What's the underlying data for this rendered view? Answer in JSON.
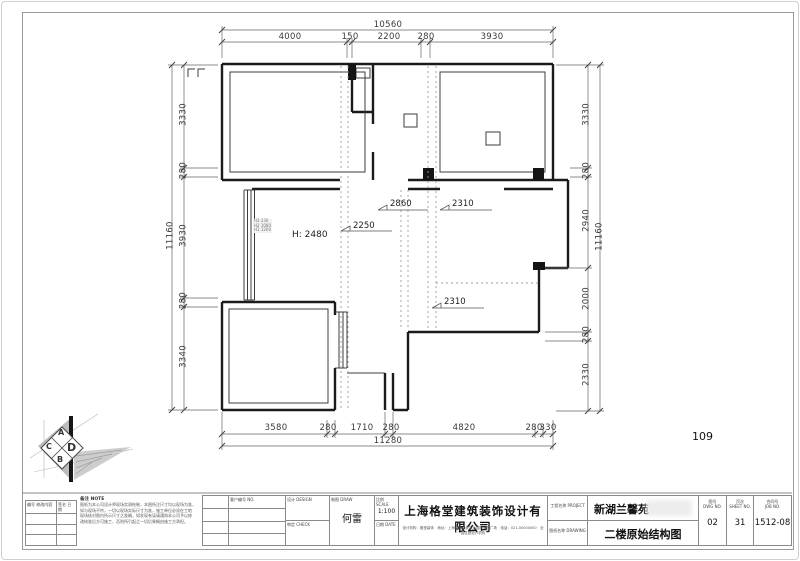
{
  "drawing": {
    "sheet_note": "109",
    "room_height": "H: 2480",
    "dim_2250": "2250",
    "dim_2860": "2860",
    "dim_2310_top": "2310",
    "dim_2310_bottom": "2310",
    "window_note_1": "H3 230",
    "window_note_2": "H2 1080",
    "window_note_3": "H1 1200"
  },
  "dims": {
    "top": {
      "overall": "10560",
      "s": [
        "4000",
        "150",
        "2200",
        "280",
        "3930"
      ]
    },
    "bottom": {
      "overall": "11280",
      "s": [
        "3580",
        "280",
        "1710",
        "280",
        "4820",
        "280",
        "330"
      ]
    },
    "left": {
      "overall": "11160",
      "s": [
        "3330",
        "280",
        "3930",
        "280",
        "3340"
      ]
    },
    "right": {
      "overall": "11160",
      "s": [
        "3330",
        "280",
        "2940",
        "2000",
        "280",
        "2330"
      ]
    }
  },
  "logo": {
    "letters": [
      "A",
      "C",
      "D",
      "B"
    ]
  },
  "titleblock": {
    "revision": {
      "col1": "编号 修改内容",
      "col2": "签名 日期"
    },
    "notes": {
      "header": "备注 NOTE",
      "line1": "图纸为本公司设计师现场实测绘制，本图所注尺寸均以现场为准，",
      "line2": "如与现场不符，一切以现场实际尺寸为准，施工单位必须在工地",
      "line3": "现场核对图内所示尺寸之准确，如发现有误请通知本公司予以修",
      "line4": "改核准后方可施工，否则所引起之一切后果概由施工方承担。"
    },
    "info_label": "客户编号 NO.",
    "fields": {
      "design_label": "设计 DESIGN",
      "design_value": "",
      "draw_label": "制图 DRAW",
      "draw_value": "何雷",
      "scale_label": "比例 SCALE",
      "scale_value": "1:100",
      "check_label": "审定 CHECK",
      "date_label": "日期 DATE",
      "date_value": ""
    },
    "company": {
      "name": "上海格堂建筑装饰设计有限公司",
      "subline": "设计机构：格堂装饰　地址：上海市红星美凯龙国际家居广场　电话：021-00000000　全国连锁设计机构"
    },
    "project": {
      "label": "工程名称 PROJECT",
      "value": "新湖兰馨苑"
    },
    "title": {
      "label": "图纸名称 DRAWING",
      "value": "二楼原始结构图"
    },
    "numbers": [
      {
        "label": "图号",
        "sublabel": "DWG NO.",
        "value": "02"
      },
      {
        "label": "页次",
        "sublabel": "SHEET NO.",
        "value": "31"
      },
      {
        "label": "合同号",
        "sublabel": "JOB NO.",
        "value": "1512-08"
      }
    ]
  }
}
